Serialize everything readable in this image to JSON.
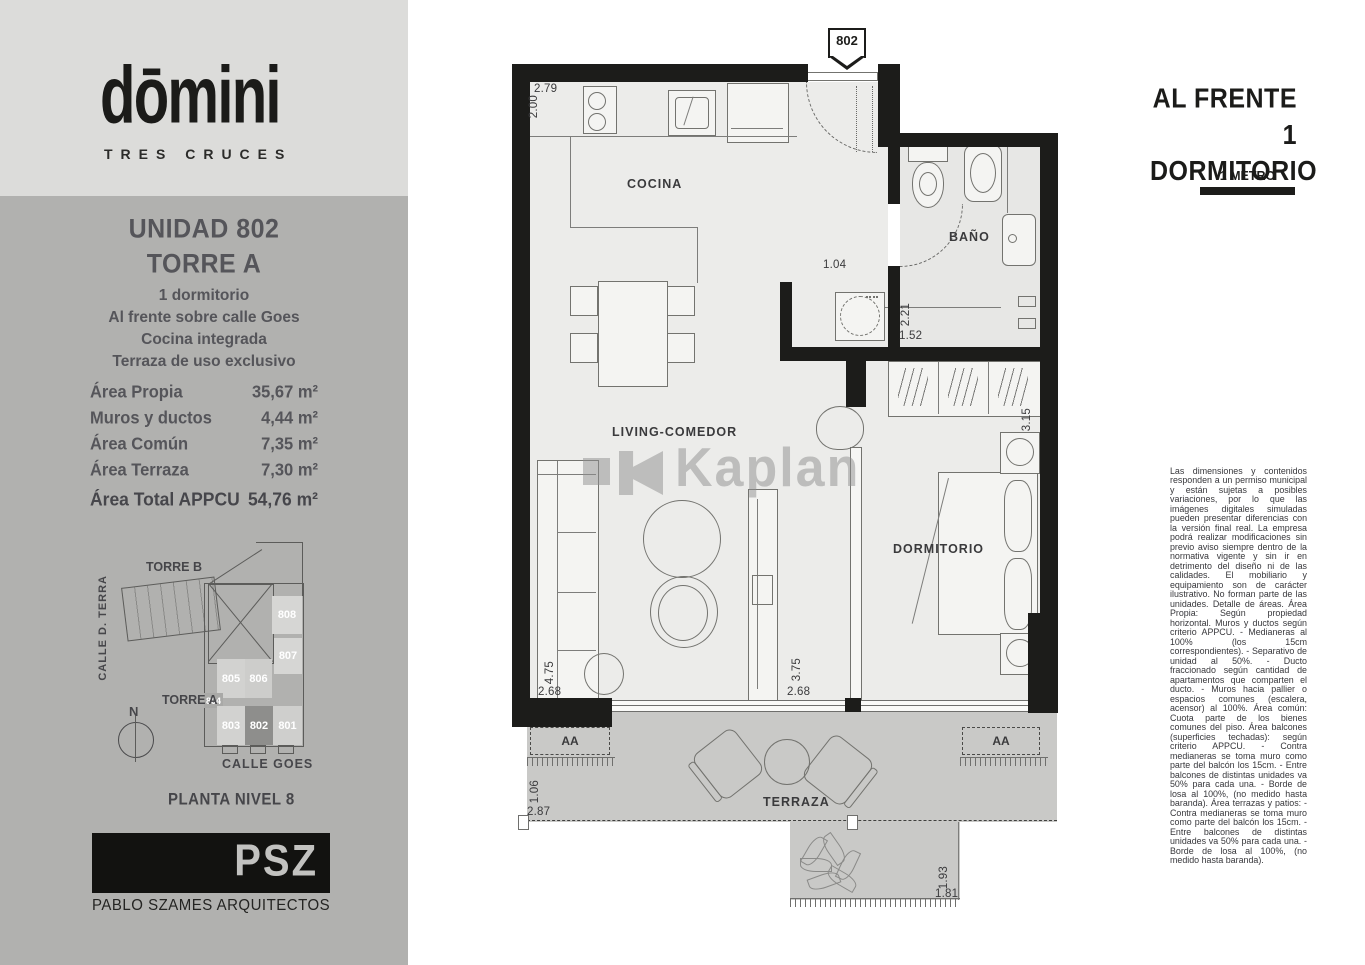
{
  "colors": {
    "sidebar_bg": "#b1b1af",
    "logo_bg": "#dcdcda",
    "wall": "#1c1c1a",
    "floor": "#ececea",
    "terrace_floor": "#c9c9c7",
    "highlight_unit_bg": "#8e8e8c",
    "heading_text": "#55555a"
  },
  "sidebar": {
    "brand": {
      "name": "dōmini",
      "tagline": "TRES CRUCES"
    },
    "unit": {
      "title": "UNIDAD 802",
      "subtitle": "TORRE A",
      "features": [
        "1 dormitorio",
        "Al frente sobre calle Goes",
        "Cocina integrada",
        "Terraza de uso exclusivo"
      ]
    },
    "areas": {
      "rows": [
        {
          "label": "Área Propia",
          "value": "35,67 m²"
        },
        {
          "label": "Muros y ductos",
          "value": "4,44 m²"
        },
        {
          "label": "Área Común",
          "value": "7,35 m²"
        },
        {
          "label": "Área Terraza",
          "value": "7,30 m²"
        }
      ],
      "total": {
        "label": "Área Total APPCU",
        "value": "54,76 m²"
      }
    },
    "siteplan": {
      "torre_b_label": "TORRE B",
      "torre_a_label": "TORRE A",
      "street_left": "CALLE D. TERRA",
      "street_bottom": "CALLE GOES",
      "compass": "N",
      "units": {
        "u808": "808",
        "u807": "807",
        "u805": "805",
        "u806": "806",
        "u804": "804",
        "u803": "803",
        "u802": "802",
        "u801": "801"
      },
      "highlighted_unit": "802",
      "caption": "PLANTA NIVEL 8"
    },
    "architect": {
      "logo": "PSZ",
      "name": "PABLO SZAMES ARQUITECTOS"
    }
  },
  "plan": {
    "unit_marker": "802",
    "watermark": "Kaplan",
    "rooms": {
      "cocina": "COCINA",
      "living": "LIVING-COMEDOR",
      "dormitorio": "DORMITORIO",
      "bano": "BAÑO",
      "terraza": "TERRAZA"
    },
    "aa_left": "AA",
    "aa_right": "AA",
    "dims": {
      "kitchen_w": "2.79",
      "kitchen_h": "2.00",
      "hall": "1.04",
      "laundry_d": "2.21",
      "laundry_w": "1.52",
      "bedroom_len": "3.15",
      "living_d": "4.75",
      "living_w": "2.68",
      "bedroom_d": "3.75",
      "bedroom_w": "2.68",
      "terrace_d": "1.06",
      "terrace_w": "2.87",
      "terrace2_d": "1.93",
      "terrace2_w": "1.81"
    }
  },
  "legend": {
    "orientation_line1": "AL FRENTE",
    "orientation_line2": "1 DORMITORIO",
    "scale_label": "1 METRO",
    "disclaimer": "Las dimensiones y contenidos responden a un permiso municipal y están sujetas a posibles variaciones, por lo que las imágenes digitales simuladas pueden presentar diferencias con la versión final real. La empresa podrá realizar modificaciones sin previo aviso siempre dentro de la normativa vigente y sin ir en detrimento del diseño ni de las calidades. El mobiliario y equipamiento son de carácter ilustrativo. No forman parte de las unidades. Detalle de áreas. Área Propia: Según propiedad horizontal. Muros y ductos según criterio APPCU. - Medianeras al 100% (los 15cm correspondientes). - Separativo de unidad al 50%. - Ducto fraccionado según cantidad de apartamentos que comparten el ducto. - Muros hacia pallier o espacios comunes (escalera, acensor) al 100%. Área común: Cuota parte de los bienes comunes del piso. Área balcones (superficies techadas): según criterio APPCU. - Contra medianeras se toma muro como parte del balcón los 15cm. - Entre balcones de distintas unidades va 50% para cada una. - Borde de losa al 100%, (no medido hasta baranda). Área terrazas y patios: - Contra medianeras se toma muro como parte del balcón los 15cm. - Entre balcones de distintas unidades va 50% para cada una. - Borde de losa al 100%, (no medido hasta baranda)."
  }
}
